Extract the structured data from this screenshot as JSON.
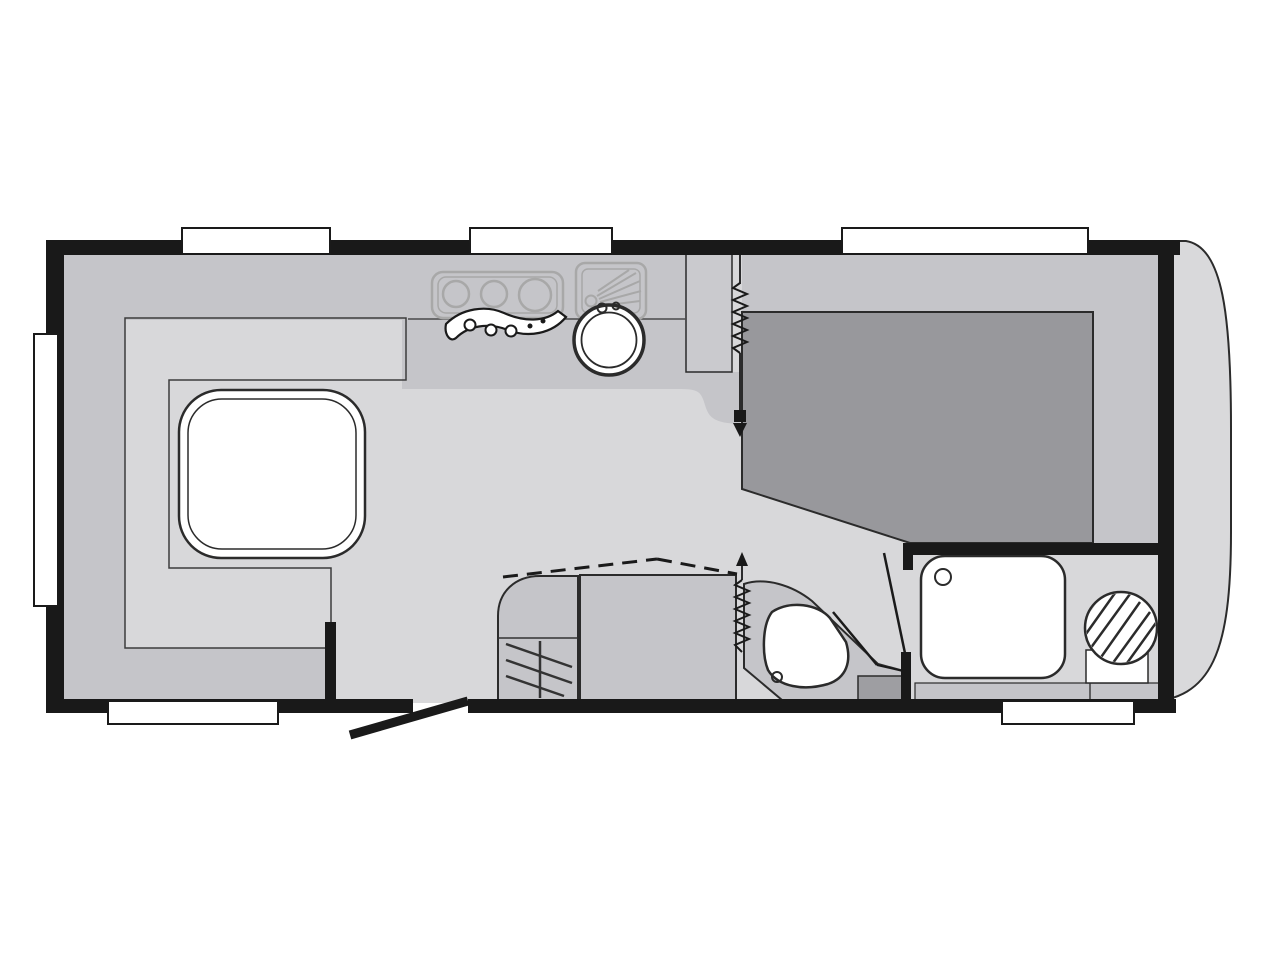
{
  "diagram": {
    "type": "caravan-floor-plan",
    "rooms": [
      "lounge",
      "kitchen",
      "bedroom",
      "washroom",
      "bathroom"
    ],
    "fixtures": [
      "u-shaped-dinette-seating",
      "dinette-table",
      "three-burner-hob",
      "kitchen-sink",
      "draining-board",
      "tall-cabinet",
      "refrigerator",
      "wardrobe",
      "double-bed",
      "vanity-basin",
      "shower-tray",
      "cassette-toilet",
      "entrance-door",
      "concertina-door",
      "window"
    ],
    "window_count": 6
  },
  "colors": {
    "background": "#ffffff",
    "wall": "#191919",
    "door": "#1a1a1a",
    "shell": "#d9d9db",
    "floor": "#d8d8da",
    "furniture": "#c5c5c9",
    "cabinet": "#cacace",
    "upholstery": "#9b9b9f",
    "bed": "#98989c",
    "fixture_white": "#ffffff",
    "hatch_box": "#9e9ea2",
    "outline": "#2b2b2b",
    "faint": "#a8a8a8",
    "counter_line": "#4a4a4a"
  }
}
